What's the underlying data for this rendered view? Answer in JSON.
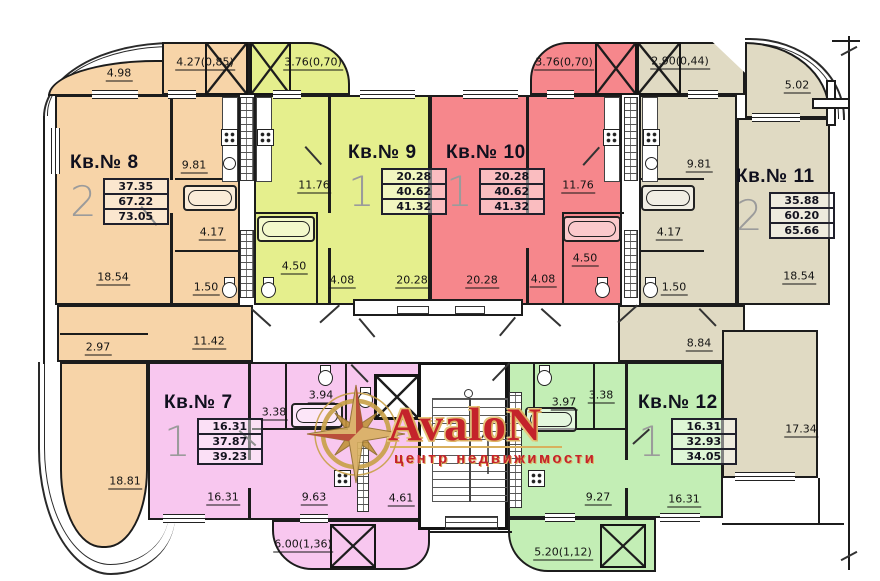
{
  "watermark": {
    "brand": "AvaloN",
    "tagline": "центр недвижимости",
    "brand_color": "#c4232b",
    "gold_color": "#d8b05e"
  },
  "apartments": [
    {
      "number": "8",
      "label": "Кв.№ 8",
      "rooms": "2",
      "areas": [
        "37.35",
        "67.22",
        "73.05"
      ],
      "color": "#f7d4a8"
    },
    {
      "number": "9",
      "label": "Кв.№ 9",
      "rooms": "1",
      "areas": [
        "20.28",
        "40.62",
        "41.32"
      ],
      "color": "#e5ef8d"
    },
    {
      "number": "10",
      "label": "Кв.№ 10",
      "rooms": "1",
      "areas": [
        "20.28",
        "40.62",
        "41.32"
      ],
      "color": "#f6878c"
    },
    {
      "number": "11",
      "label": "Кв.№ 11",
      "rooms": "2",
      "areas": [
        "35.88",
        "60.20",
        "65.66"
      ],
      "color": "#e0dac3"
    },
    {
      "number": "7",
      "label": "Кв.№ 7",
      "rooms": "1",
      "areas": [
        "16.31",
        "37.87",
        "39.23"
      ],
      "color": "#f8c7ef"
    },
    {
      "number": "12",
      "label": "Кв.№ 12",
      "rooms": "1",
      "areas": [
        "16.31",
        "32.93",
        "34.05"
      ],
      "color": "#c3eeb5"
    }
  ],
  "dimensions": [
    {
      "text": "4.98",
      "x": 119,
      "y": 74
    },
    {
      "text": "4.27(0,85)",
      "x": 205,
      "y": 63
    },
    {
      "text": "3.76(0,70)",
      "x": 313,
      "y": 63
    },
    {
      "text": "3.76(0,70)",
      "x": 564,
      "y": 63
    },
    {
      "text": "2.90(0,44)",
      "x": 680,
      "y": 62
    },
    {
      "text": "5.02",
      "x": 797,
      "y": 86
    },
    {
      "text": "9.81",
      "x": 194,
      "y": 166
    },
    {
      "text": "11.76",
      "x": 314,
      "y": 186
    },
    {
      "text": "4.50",
      "x": 294,
      "y": 267
    },
    {
      "text": "4.08",
      "x": 342,
      "y": 281
    },
    {
      "text": "20.28",
      "x": 412,
      "y": 281
    },
    {
      "text": "4.17",
      "x": 212,
      "y": 233
    },
    {
      "text": "1.50",
      "x": 206,
      "y": 288
    },
    {
      "text": "18.54",
      "x": 113,
      "y": 278
    },
    {
      "text": "20.28",
      "x": 482,
      "y": 281
    },
    {
      "text": "4.08",
      "x": 543,
      "y": 280
    },
    {
      "text": "4.50",
      "x": 585,
      "y": 259
    },
    {
      "text": "11.76",
      "x": 578,
      "y": 186
    },
    {
      "text": "9.81",
      "x": 699,
      "y": 165
    },
    {
      "text": "4.17",
      "x": 669,
      "y": 233
    },
    {
      "text": "1.50",
      "x": 674,
      "y": 288
    },
    {
      "text": "18.54",
      "x": 799,
      "y": 277
    },
    {
      "text": "2.97",
      "x": 98,
      "y": 348
    },
    {
      "text": "11.42",
      "x": 209,
      "y": 342
    },
    {
      "text": "18.81",
      "x": 125,
      "y": 482
    },
    {
      "text": "8.84",
      "x": 699,
      "y": 344
    },
    {
      "text": "17.34",
      "x": 801,
      "y": 430
    },
    {
      "text": "3.94",
      "x": 321,
      "y": 396
    },
    {
      "text": "3.38",
      "x": 274,
      "y": 413
    },
    {
      "text": "16.31",
      "x": 223,
      "y": 498
    },
    {
      "text": "9.63",
      "x": 314,
      "y": 498
    },
    {
      "text": "4.61",
      "x": 401,
      "y": 499
    },
    {
      "text": "6.00(1,36)",
      "x": 303,
      "y": 545
    },
    {
      "text": "3.97",
      "x": 564,
      "y": 403
    },
    {
      "text": "3.38",
      "x": 601,
      "y": 396
    },
    {
      "text": "9.27",
      "x": 598,
      "y": 498
    },
    {
      "text": "16.31",
      "x": 684,
      "y": 500
    },
    {
      "text": "5.20(1,12)",
      "x": 563,
      "y": 553
    }
  ]
}
